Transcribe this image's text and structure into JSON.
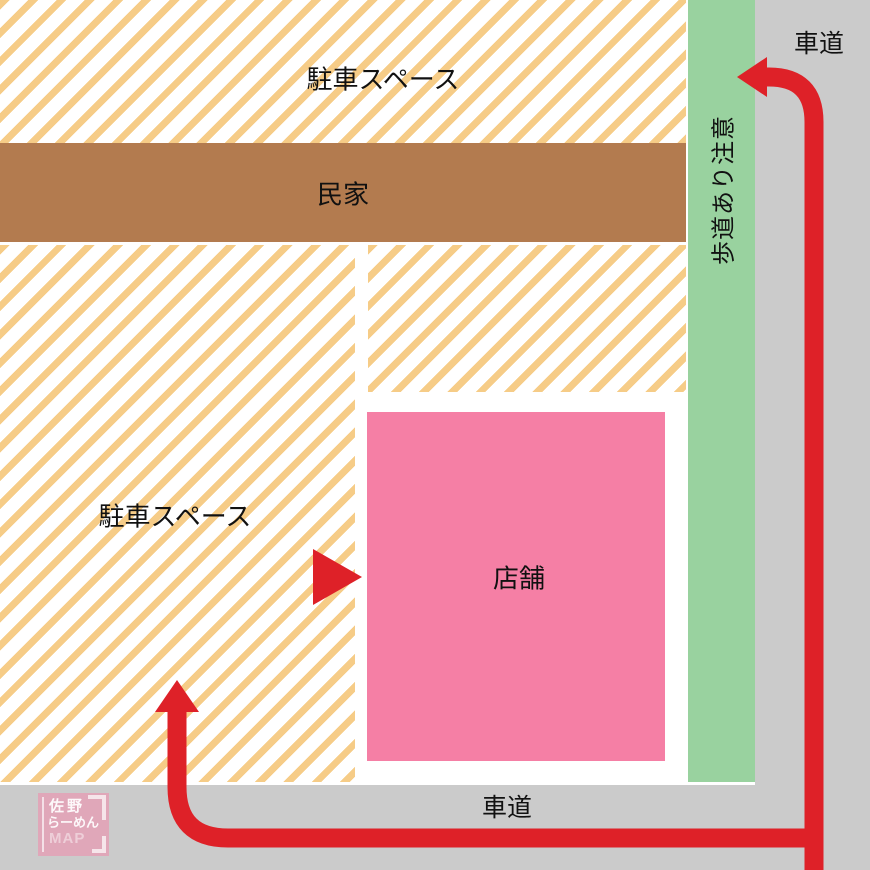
{
  "map": {
    "areas": {
      "top_parking": {
        "label": "駐車スペース"
      },
      "house": {
        "label": "民家"
      },
      "left_parking": {
        "label": "駐車スペース"
      },
      "store": {
        "label": "店舗"
      },
      "sidewalk": {
        "label": "歩道あり注意"
      }
    },
    "roads": {
      "top_right": {
        "label": "車道"
      },
      "bottom": {
        "label": "車道"
      }
    },
    "logo": {
      "line1": "佐野",
      "line2": "らーめん",
      "line3": "MAP"
    },
    "colors": {
      "stripe": "#F6CC87",
      "house": "#B37B4F",
      "store": "#F57FA5",
      "sidewalk": "#99D29F",
      "road": "#CBCBCB",
      "route": "#DE2128",
      "text": "#111111",
      "logo_pink": "#F38AAC"
    }
  }
}
